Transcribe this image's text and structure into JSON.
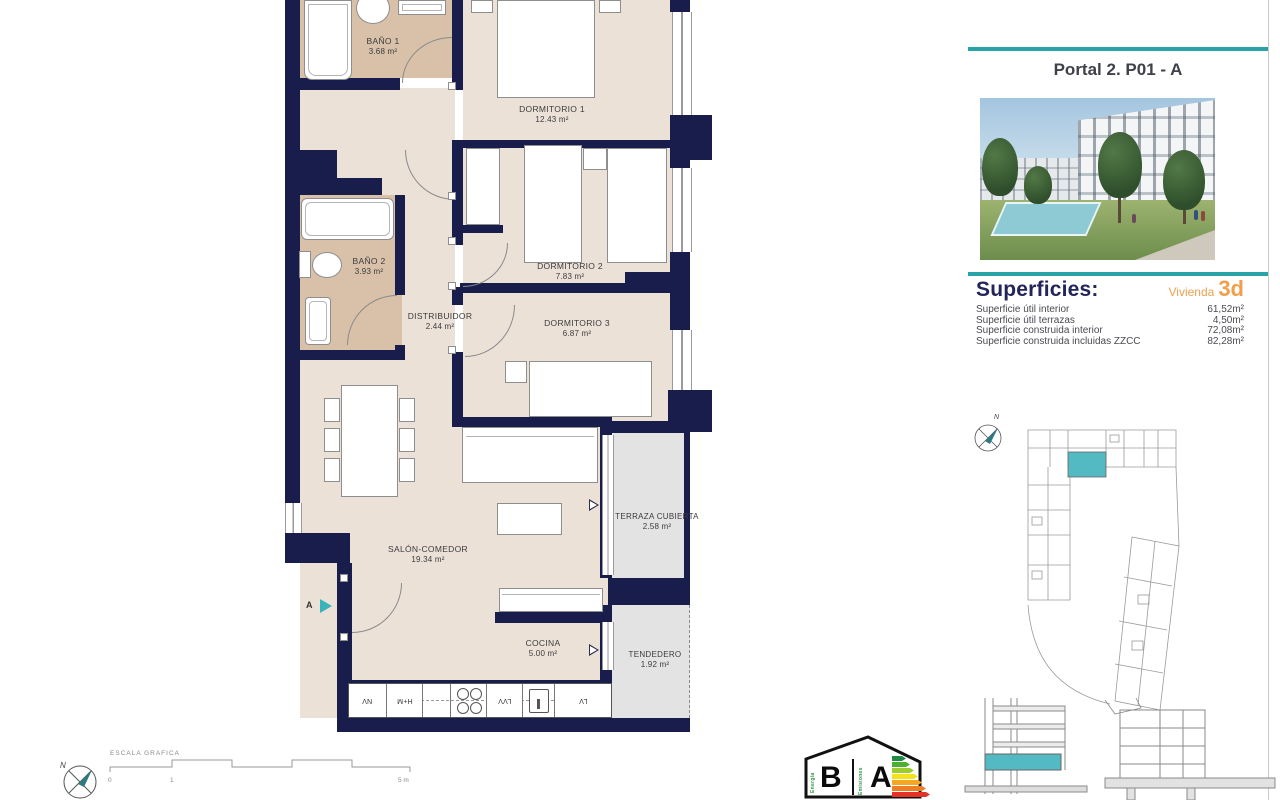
{
  "header": {
    "title": "Portal 2. P01 - A"
  },
  "superficies": {
    "heading": "Superficies:",
    "vivienda_label": "Vivienda",
    "vivienda_code": "3d",
    "rows": [
      {
        "label": "Superficie útil interior",
        "value": "61,52m²"
      },
      {
        "label": "Superficie útil terrazas",
        "value": "4,50m²"
      },
      {
        "label": "Superficie construida interior",
        "value": "72,08m²"
      },
      {
        "label": "Superficie construida incluidas ZZCC",
        "value": "82,28m²"
      }
    ]
  },
  "rooms": [
    {
      "name": "BAÑO 1",
      "area": "3.68 m²"
    },
    {
      "name": "DORMITORIO 1",
      "area": "12.43 m²"
    },
    {
      "name": "BAÑO 2",
      "area": "3.93 m²"
    },
    {
      "name": "DISTRIBUIDOR",
      "area": "2.44 m²"
    },
    {
      "name": "DORMITORIO 2",
      "area": "7.83 m²"
    },
    {
      "name": "DORMITORIO 3",
      "area": "6.87 m²"
    },
    {
      "name": "SALÓN-COMEDOR",
      "area": "19.34 m²"
    },
    {
      "name": "COCINA",
      "area": "5.00 m²"
    },
    {
      "name": "TERRAZA CUBIERTA",
      "area": "2.58 m²"
    },
    {
      "name": "TENDEDERO",
      "area": "1.92 m²"
    }
  ],
  "kitchen": {
    "units": [
      "NV",
      "H+M",
      "LVV",
      "LV"
    ]
  },
  "markers": {
    "section": "A"
  },
  "compass": {
    "north": "N"
  },
  "scalebar": {
    "title": "ESCALA GRAFICA",
    "tick0": "0",
    "tick1": "1",
    "tick5": "5 m"
  },
  "energy": {
    "letter_left": "B",
    "letter_right": "A",
    "text_left": "Energía",
    "text_right": "Emisiones",
    "bar_colors": [
      "#1f8b43",
      "#4caf2e",
      "#9ccc2e",
      "#f2e21b",
      "#f5a623",
      "#ef7d21",
      "#e53228"
    ]
  },
  "colors": {
    "accent_teal": "#2aa3a8",
    "wall_navy": "#191d4c",
    "floor_beige": "#ece1d7",
    "bath_tan": "#d8c1a8",
    "terrace_gray": "#e3e3e3",
    "unit_highlight": "#53bac3",
    "orange": "#f0a04c"
  }
}
